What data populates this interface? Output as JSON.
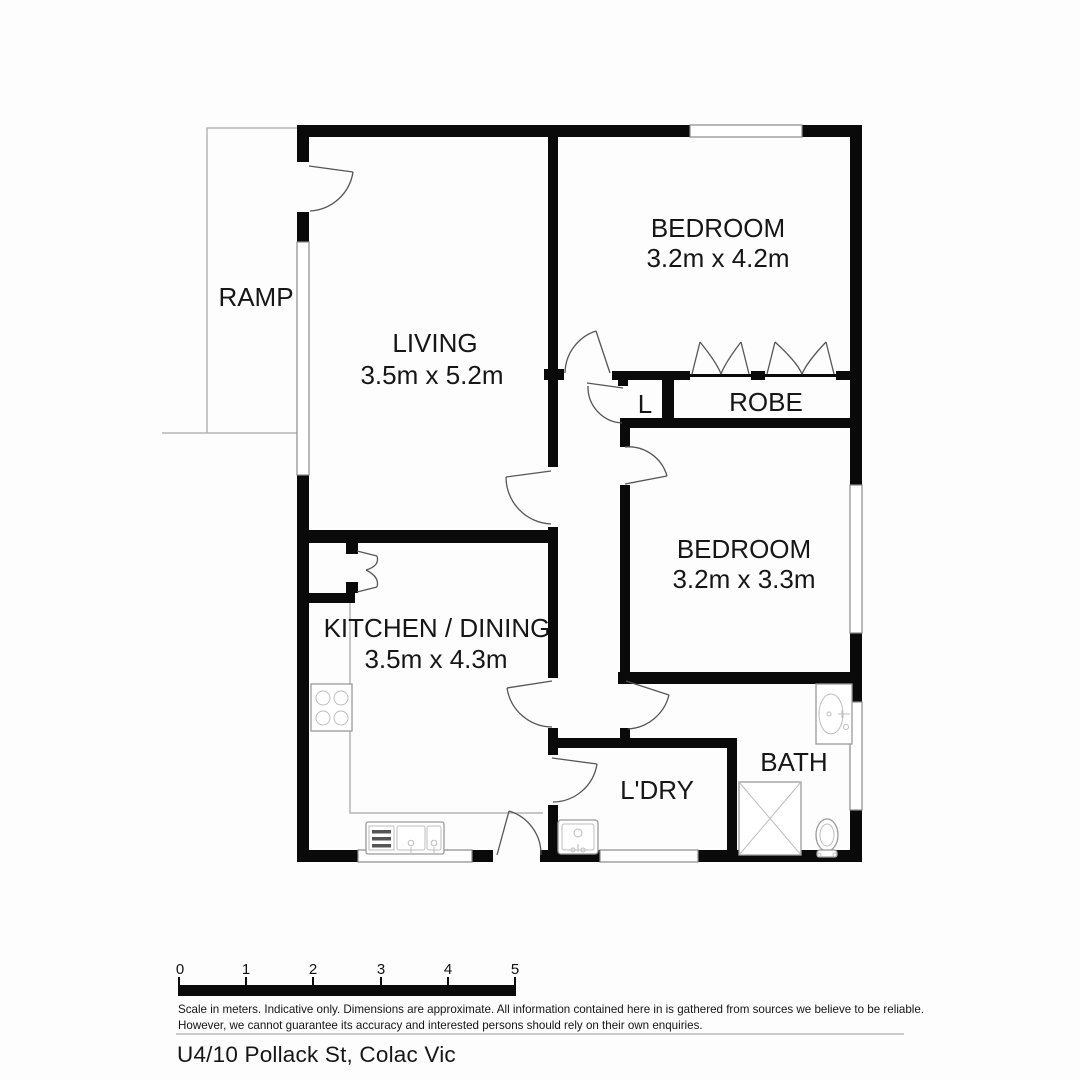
{
  "plan": {
    "rooms": [
      {
        "id": "living",
        "name": "LIVING",
        "dims": "3.5m x 5.2m"
      },
      {
        "id": "bedroom1",
        "name": "BEDROOM",
        "dims": "3.2m x 4.2m"
      },
      {
        "id": "bedroom2",
        "name": "BEDROOM",
        "dims": "3.2m x 3.3m"
      },
      {
        "id": "kitchen",
        "name": "KITCHEN / DINING",
        "dims": "3.5m x 4.3m"
      },
      {
        "id": "bath",
        "name": "BATH"
      },
      {
        "id": "laundry",
        "name": "L'DRY"
      },
      {
        "id": "robe",
        "name": "ROBE"
      },
      {
        "id": "linen",
        "name": "L"
      },
      {
        "id": "ramp",
        "name": "RAMP"
      }
    ],
    "fixtures": [
      "stove",
      "kitchen-sink",
      "laundry-trough",
      "vanity-basin",
      "shower",
      "toilet"
    ],
    "colors": {
      "walls": "#0a0a0a",
      "thin_lines": "#9a9a9a",
      "text": "#161616"
    }
  },
  "scale_bar": {
    "tick_labels": [
      "0",
      "1",
      "2",
      "3",
      "4",
      "5"
    ],
    "caption_line1": "Scale in meters. Indicative only. Dimensions are approximate. All information contained here in is gathered from sources we believe to be reliable.",
    "caption_line2": "However, we cannot guarantee its accuracy and interested persons should rely on their own enquiries."
  },
  "footer": {
    "address": "U4/10 Pollack St, Colac Vic"
  }
}
